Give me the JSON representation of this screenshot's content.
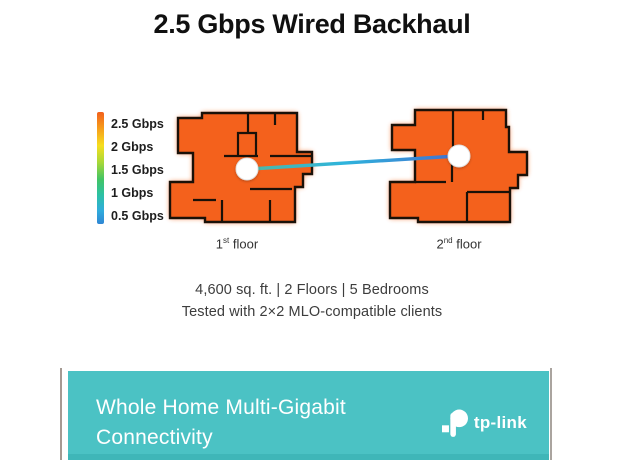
{
  "title": "2.5 Gbps Wired Backhaul",
  "legend": {
    "items": [
      {
        "label": "2.5 Gbps",
        "color": "#f2601c"
      },
      {
        "label": "2 Gbps",
        "color": "#f6b31b"
      },
      {
        "label": "1.5 Gbps",
        "color": "#c6d92c"
      },
      {
        "label": "1 Gbps",
        "color": "#3ec46a"
      },
      {
        "label": "0.5 Gbps",
        "color": "#2f9fd8"
      }
    ],
    "gradient_top_to_bottom": [
      "#f2601c",
      "#f69b1a",
      "#f6de1f",
      "#a8d838",
      "#43c464",
      "#2cc1a4",
      "#30acdc",
      "#2f86d4"
    ]
  },
  "floorplan": {
    "fill_color": "#f4611c",
    "wall_color": "#1a1108",
    "node_color": "#ffffff",
    "link_gradient": [
      "#4fb9a6",
      "#2eb4dc",
      "#4170d0"
    ]
  },
  "floors": [
    {
      "num": "1",
      "ordinal": "st",
      "word": "floor"
    },
    {
      "num": "2",
      "ordinal": "nd",
      "word": "floor"
    }
  ],
  "specs": {
    "line1": "4,600 sq. ft. | 2 Floors | 5 Bedrooms",
    "line2": "Tested with 2×2 MLO-compatible clients"
  },
  "banner": {
    "line1": "Whole Home Multi-Gigabit",
    "line2": "Connectivity",
    "brand": "tp-link",
    "bg_color": "#4bc2c4"
  }
}
